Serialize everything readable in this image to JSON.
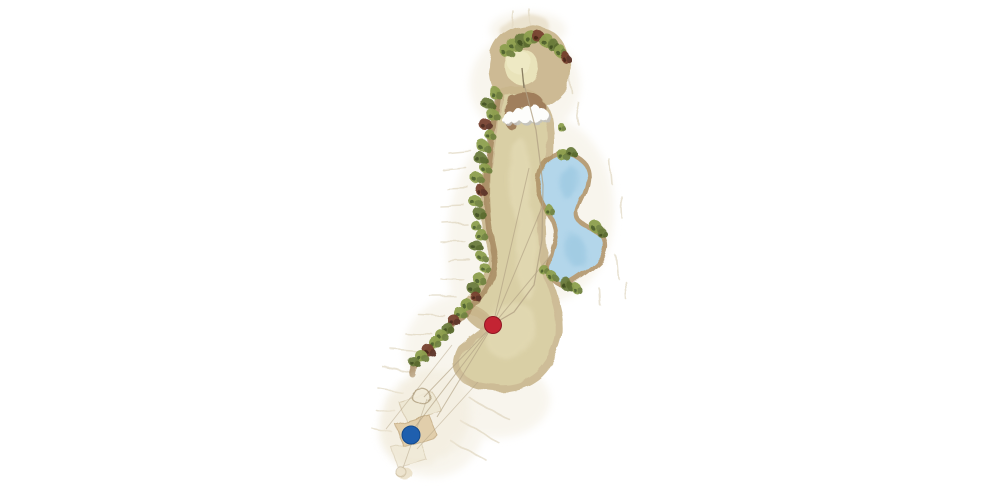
{
  "meta": {
    "view": "golf-hole-overhead-plan",
    "background": "#ffffff",
    "style": "watercolor"
  },
  "palette": {
    "silhouette_wash": "#f2ecdd",
    "rough_corridor": "#c9b68d",
    "fairway": "#d9cfa5",
    "fairway_light": "#e4dbb6",
    "green_surface": "#e9e3ba",
    "green_highlight": "#efeac6",
    "bunker_sand": "#fdfdfb",
    "bunker_shadow": "#c2c2c0",
    "pocket_brown": "#9d7c5a",
    "cart_path": "#a78a62",
    "water": "#b3d6ea",
    "water_deep": "#98c6e0",
    "water_shore": "#ad9066",
    "line": "#b1a184",
    "tee_box": "#dfc9a2",
    "tee_box_faint": "#ece3cc",
    "flag_stick": "#8a7f63",
    "tree_variants": {
      "g": [
        "#8da04e",
        "#70823f",
        "#4f612c"
      ],
      "d": [
        "#6b7c3c",
        "#57692e",
        "#3f4f20"
      ],
      "m": [
        "#77412f",
        "#5c3226",
        "#472417"
      ]
    }
  },
  "hole": {
    "markers": [
      {
        "id": "tee-marker-blue",
        "type": "tee-position",
        "color": "#1f5fae",
        "ring": "#154a8c",
        "x": 411,
        "y": 435,
        "r": 9
      },
      {
        "id": "landing-marker-red",
        "type": "landing-position",
        "color": "#c32433",
        "ring": "#8e1623",
        "x": 493,
        "y": 325,
        "r": 8.5
      }
    ],
    "flag": {
      "x1": 522,
      "y1": 68,
      "x2": 524,
      "y2": 88
    },
    "center_line": [
      [
        523,
        80
      ],
      [
        536,
        130
      ],
      [
        543,
        185
      ],
      [
        542,
        240
      ],
      [
        534,
        285
      ],
      [
        514,
        312
      ],
      [
        495,
        323
      ]
    ],
    "fan_lines": [
      [
        [
          493,
          325
        ],
        [
          529,
          168
        ]
      ],
      [
        [
          493,
          325
        ],
        [
          543,
          205
        ]
      ],
      [
        [
          493,
          325
        ],
        [
          551,
          255
        ]
      ],
      [
        [
          493,
          325
        ],
        [
          424,
          397
        ]
      ],
      [
        [
          493,
          325
        ],
        [
          437,
          417
        ]
      ],
      [
        [
          493,
          325
        ],
        [
          412,
          431
        ]
      ]
    ],
    "tee_lines": [
      [
        [
          403,
          468
        ],
        [
          427,
          399
        ]
      ],
      [
        [
          386,
          429
        ],
        [
          452,
          345
        ]
      ],
      [
        [
          417,
          449
        ],
        [
          478,
          382
        ]
      ]
    ],
    "trees": [
      [
        507,
        52,
        6,
        "g"
      ],
      [
        514,
        45,
        6,
        "g"
      ],
      [
        522,
        40,
        7,
        "d"
      ],
      [
        530,
        37,
        7,
        "g"
      ],
      [
        538,
        36,
        6,
        "m"
      ],
      [
        546,
        40,
        7,
        "g"
      ],
      [
        553,
        45,
        6,
        "d"
      ],
      [
        560,
        51,
        6,
        "g"
      ],
      [
        565,
        57,
        5,
        "m"
      ],
      [
        561,
        127,
        4,
        "g"
      ],
      [
        494,
        92,
        6,
        "g"
      ],
      [
        487,
        103,
        6,
        "d"
      ],
      [
        492,
        114,
        6,
        "g"
      ],
      [
        485,
        124,
        6,
        "m"
      ],
      [
        490,
        135,
        5,
        "g"
      ],
      [
        483,
        146,
        6,
        "g"
      ],
      [
        480,
        158,
        6,
        "d"
      ],
      [
        485,
        168,
        5,
        "g"
      ],
      [
        478,
        179,
        6,
        "g"
      ],
      [
        481,
        191,
        5,
        "m"
      ],
      [
        475,
        201,
        6,
        "g"
      ],
      [
        479,
        213,
        6,
        "d"
      ],
      [
        474,
        224,
        5,
        "g"
      ],
      [
        480,
        234,
        6,
        "g"
      ],
      [
        476,
        246,
        6,
        "d"
      ],
      [
        482,
        257,
        5,
        "g"
      ],
      [
        485,
        268,
        5,
        "g"
      ],
      [
        479,
        279,
        6,
        "g"
      ],
      [
        473,
        288,
        6,
        "d"
      ],
      [
        476,
        297,
        5,
        "m"
      ],
      [
        467,
        305,
        6,
        "g"
      ],
      [
        460,
        313,
        6,
        "g"
      ],
      [
        454,
        321,
        6,
        "m"
      ],
      [
        448,
        329,
        6,
        "d"
      ],
      [
        442,
        336,
        6,
        "g"
      ],
      [
        435,
        343,
        6,
        "g"
      ],
      [
        428,
        350,
        6,
        "m"
      ],
      [
        421,
        356,
        6,
        "g"
      ],
      [
        414,
        362,
        5,
        "d"
      ],
      [
        563,
        155,
        6,
        "g"
      ],
      [
        571,
        152,
        5,
        "d"
      ],
      [
        548,
        209,
        5,
        "g"
      ],
      [
        596,
        227,
        6,
        "g"
      ],
      [
        602,
        233,
        5,
        "d"
      ],
      [
        545,
        271,
        5,
        "g"
      ],
      [
        553,
        277,
        5,
        "g"
      ],
      [
        566,
        284,
        6,
        "d"
      ],
      [
        576,
        288,
        5,
        "g"
      ]
    ],
    "features": [
      {
        "name": "green"
      },
      {
        "name": "flagstick"
      },
      {
        "name": "greenside-bunker"
      },
      {
        "name": "water-hazard"
      },
      {
        "name": "fairway"
      },
      {
        "name": "tree-line"
      },
      {
        "name": "cart-path"
      },
      {
        "name": "tee-boxes"
      }
    ]
  }
}
